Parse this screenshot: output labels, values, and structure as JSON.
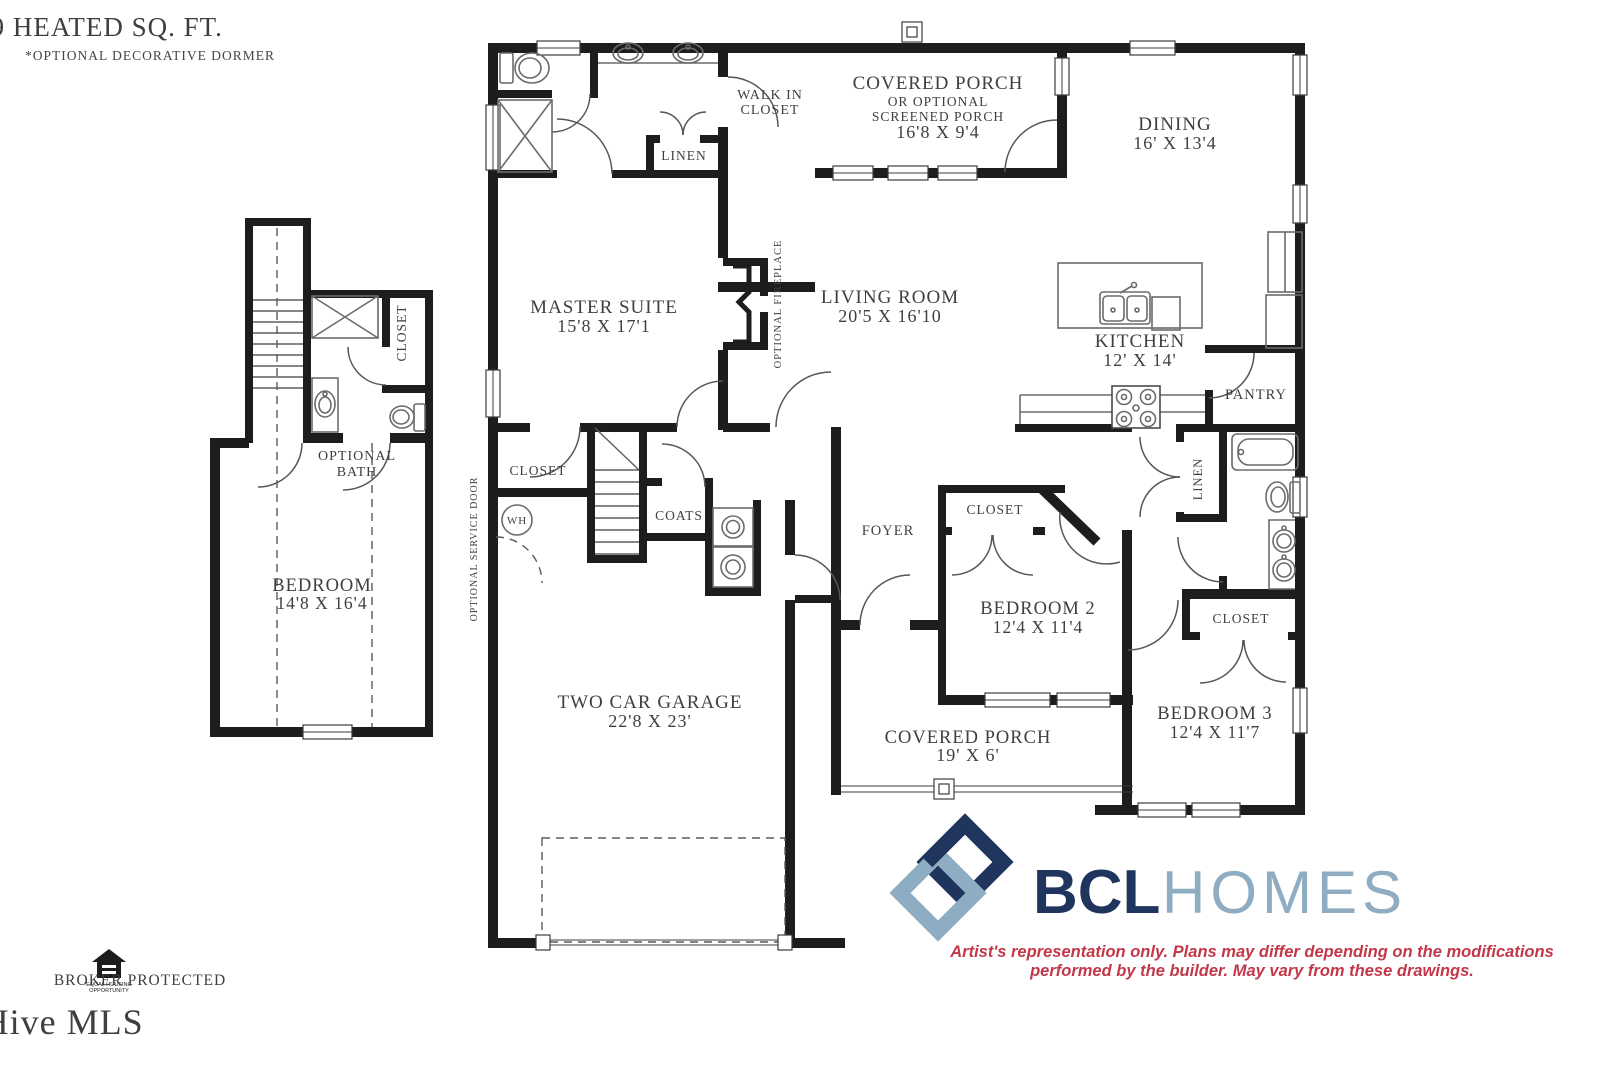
{
  "meta": {
    "title": "2459 HEATED SQ. FT.",
    "subtitle": "*OPTIONAL DECORATIVE DORMER"
  },
  "rooms": {
    "covered_porch_top": {
      "line1": "COVERED PORCH",
      "line2": "OR OPTIONAL",
      "line3": "SCREENED PORCH",
      "dims": "16'8 X 9'4"
    },
    "dining": {
      "name": "DINING",
      "dims": "16' X 13'4"
    },
    "walk_in_closet": {
      "line1": "WALK IN",
      "line2": "CLOSET"
    },
    "linen_master": {
      "name": "LINEN"
    },
    "master_suite": {
      "name": "MASTER SUITE",
      "dims": "15'8 X 17'1"
    },
    "living_room": {
      "name": "LIVING ROOM",
      "dims": "20'5 X 16'10"
    },
    "optional_fireplace": {
      "name": "OPTIONAL FIREPLACE"
    },
    "kitchen": {
      "name": "KITCHEN",
      "dims": "12' X 14'"
    },
    "pantry": {
      "name": "PANTRY"
    },
    "closet_bonus": {
      "name": "CLOSET"
    },
    "optional_bath": {
      "line1": "OPTIONAL",
      "line2": "BATH"
    },
    "bedroom_bonus": {
      "name": "BEDROOM",
      "dims": "14'8 X 16'4"
    },
    "closet_master": {
      "name": "CLOSET"
    },
    "water_heater": {
      "abbr": "WH"
    },
    "optional_service_door": {
      "name": "OPTIONAL SERVICE DOOR"
    },
    "coats": {
      "name": "COATS"
    },
    "foyer": {
      "name": "FOYER"
    },
    "closet_bedroom2": {
      "name": "CLOSET"
    },
    "bedroom2": {
      "name": "BEDROOM 2",
      "dims": "12'4 X 11'4"
    },
    "linen_hall": {
      "name": "LINEN"
    },
    "closet_bedroom3": {
      "name": "CLOSET"
    },
    "bedroom3": {
      "name": "BEDROOM 3",
      "dims": "12'4 X 11'7"
    },
    "garage": {
      "name": "TWO CAR GARAGE",
      "dims": "22'8 X 23'"
    },
    "covered_porch_bottom": {
      "name": "COVERED PORCH",
      "dims": "19' X 6'"
    }
  },
  "branding": {
    "logo_primary": "BCL",
    "logo_secondary": "HOMES",
    "disclaimer_line1": "Artist's representation only. Plans may differ depending on the modifications",
    "disclaimer_line2": "performed by the builder. May vary from these drawings.",
    "colors": {
      "navy": "#20355e",
      "steel": "#8fadc2",
      "red": "#c23848"
    }
  },
  "footer": {
    "equal_housing_line1": "EQUAL HOUSING",
    "equal_housing_line2": "OPPORTUNITY",
    "broker_protected": "BROKER PROTECTED",
    "copyright": "©2026 Hive MLS"
  }
}
